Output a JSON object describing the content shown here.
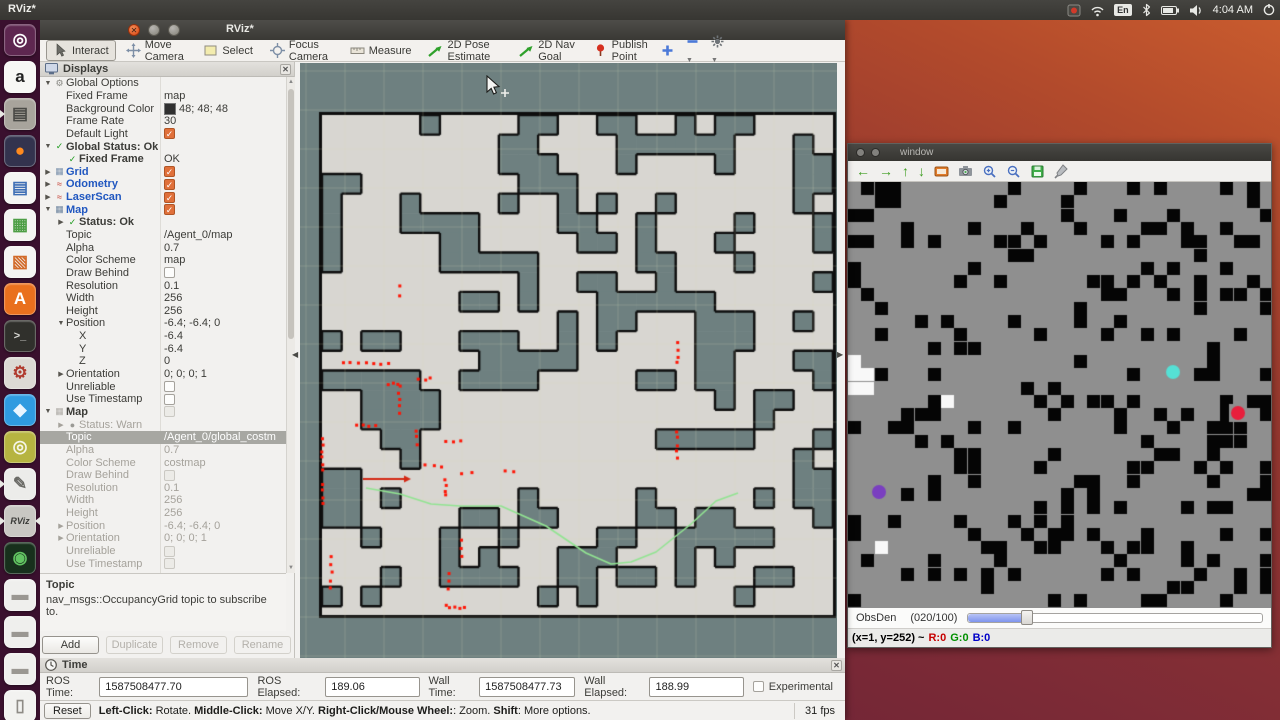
{
  "desktop": {
    "top_title": "RViz*",
    "clock": "4:04 AM",
    "keyboard_layout": "En"
  },
  "launcher": {
    "items": [
      {
        "id": "ubuntu-dash",
        "bg": "#5e2750",
        "fg": "#ffffff",
        "glyph": "◎",
        "run": false,
        "focus": false
      },
      {
        "id": "amazon",
        "bg": "#f7f7f5",
        "fg": "#222222",
        "glyph": "a",
        "run": false,
        "focus": false
      },
      {
        "id": "files",
        "bg": "#a8a49c",
        "fg": "#4a4a46",
        "glyph": "▤",
        "run": true,
        "focus": false
      },
      {
        "id": "firefox",
        "bg": "#33334e",
        "fg": "#ff8a1e",
        "glyph": "●",
        "run": false,
        "focus": false
      },
      {
        "id": "libreoffice-writer",
        "bg": "#f4f4f2",
        "fg": "#3f6fb5",
        "glyph": "▤",
        "run": false,
        "focus": false
      },
      {
        "id": "libreoffice-calc",
        "bg": "#f4f4f2",
        "fg": "#4d9e45",
        "glyph": "▦",
        "run": false,
        "focus": false
      },
      {
        "id": "libreoffice-impress",
        "bg": "#f4f4f2",
        "fg": "#d26a28",
        "glyph": "▧",
        "run": false,
        "focus": false
      },
      {
        "id": "ubuntu-software",
        "bg": "#e9701e",
        "fg": "#ffffff",
        "glyph": "A",
        "run": false,
        "focus": false
      },
      {
        "id": "terminal",
        "bg": "#30302c",
        "fg": "#d8d8d4",
        "glyph": ">_",
        "run": false,
        "focus": false
      },
      {
        "id": "system-settings",
        "bg": "#dcd9d4",
        "fg": "#b03a2e",
        "glyph": "⚙",
        "run": false,
        "focus": false
      },
      {
        "id": "vscode",
        "bg": "#2f9be0",
        "fg": "#eaf6ff",
        "glyph": "◆",
        "run": false,
        "focus": false
      },
      {
        "id": "screenshot-tool",
        "bg": "#b6b441",
        "fg": "#f5f5e8",
        "glyph": "◎",
        "run": false,
        "focus": false
      },
      {
        "id": "text-editor",
        "bg": "#ececea",
        "fg": "#6a6a66",
        "glyph": "✎",
        "run": true,
        "focus": false
      },
      {
        "id": "rviz",
        "bg": "#c9c7c3",
        "fg": "#3a3a38",
        "glyph": "RViz",
        "run": true,
        "focus": true
      },
      {
        "id": "camera-lens",
        "bg": "#17301c",
        "fg": "#62c462",
        "glyph": "◉",
        "run": false,
        "focus": false
      },
      {
        "id": "disk-drive-1",
        "bg": "#efefed",
        "fg": "#9a9792",
        "glyph": "▬",
        "run": false,
        "focus": false
      },
      {
        "id": "disk-drive-2",
        "bg": "#efefed",
        "fg": "#9a9792",
        "glyph": "▬",
        "run": false,
        "focus": false
      },
      {
        "id": "disk-drive-3",
        "bg": "#efefed",
        "fg": "#9a9792",
        "glyph": "▬",
        "run": false,
        "focus": false
      },
      {
        "id": "trash",
        "bg": "#f2f2f0",
        "fg": "#8e8b86",
        "glyph": "▯",
        "run": false,
        "focus": false
      }
    ]
  },
  "rviz": {
    "title": "RViz*",
    "toolbar": {
      "tools": [
        {
          "icon": "interact",
          "label": "Interact",
          "active": true
        },
        {
          "icon": "move-camera",
          "label": "Move Camera",
          "active": false
        },
        {
          "icon": "select",
          "label": "Select",
          "active": false
        },
        {
          "icon": "focus-camera",
          "label": "Focus Camera",
          "active": false
        },
        {
          "icon": "measure",
          "label": "Measure",
          "active": false
        },
        {
          "icon": "pose-estimate",
          "label": "2D Pose Estimate",
          "active": false
        },
        {
          "icon": "nav-goal",
          "label": "2D Nav Goal",
          "active": false
        },
        {
          "icon": "publish-point",
          "label": "Publish Point",
          "active": false
        }
      ]
    },
    "displays": {
      "title": "Displays",
      "rows": [
        [
          0,
          "v",
          "gear",
          "Global Options",
          "n",
          "",
          "",
          0
        ],
        [
          1,
          "",
          "",
          "Fixed Frame",
          "n",
          "map",
          "text",
          0
        ],
        [
          1,
          "",
          "",
          "Background Color",
          "n",
          "48; 48; 48",
          "color",
          0
        ],
        [
          1,
          "",
          "",
          "Frame Rate",
          "n",
          "30",
          "text",
          0
        ],
        [
          1,
          "",
          "",
          "Default Light",
          "n",
          "",
          "cb-on",
          0
        ],
        [
          0,
          "v",
          "check",
          "Global Status: Ok",
          "bd",
          "",
          "",
          0
        ],
        [
          1,
          "",
          "check",
          "Fixed Frame",
          "bd",
          "OK",
          "text",
          0
        ],
        [
          0,
          "r",
          "grid",
          "Grid",
          "b",
          "",
          "cb-on",
          0
        ],
        [
          0,
          "r",
          "odom",
          "Odometry",
          "b",
          "",
          "cb-on",
          0
        ],
        [
          0,
          "r",
          "laser",
          "LaserScan",
          "b",
          "",
          "cb-on",
          0
        ],
        [
          0,
          "v",
          "map",
          "Map",
          "b",
          "",
          "cb-on",
          0
        ],
        [
          1,
          "r",
          "check",
          "Status: Ok",
          "bd",
          "",
          "",
          0
        ],
        [
          1,
          "",
          "",
          "Topic",
          "n",
          "/Agent_0/map",
          "text",
          0
        ],
        [
          1,
          "",
          "",
          "Alpha",
          "n",
          "0.7",
          "text",
          0
        ],
        [
          1,
          "",
          "",
          "Color Scheme",
          "n",
          "map",
          "text",
          0
        ],
        [
          1,
          "",
          "",
          "Draw Behind",
          "n",
          "",
          "cb-off",
          0
        ],
        [
          1,
          "",
          "",
          "Resolution",
          "n",
          "0.1",
          "text",
          0
        ],
        [
          1,
          "",
          "",
          "Width",
          "n",
          "256",
          "text",
          0
        ],
        [
          1,
          "",
          "",
          "Height",
          "n",
          "256",
          "text",
          0
        ],
        [
          1,
          "v",
          "",
          "Position",
          "n",
          "-6.4; -6.4; 0",
          "text",
          0
        ],
        [
          2,
          "",
          "",
          "X",
          "n",
          "-6.4",
          "text",
          0
        ],
        [
          2,
          "",
          "",
          "Y",
          "n",
          "-6.4",
          "text",
          0
        ],
        [
          2,
          "",
          "",
          "Z",
          "n",
          "0",
          "text",
          0
        ],
        [
          1,
          "r",
          "",
          "Orientation",
          "n",
          "0; 0; 0; 1",
          "text",
          0
        ],
        [
          1,
          "",
          "",
          "Unreliable",
          "n",
          "",
          "cb-off",
          0
        ],
        [
          1,
          "",
          "",
          "Use Timestamp",
          "n",
          "",
          "cb-off",
          0
        ],
        [
          0,
          "v",
          "mapg",
          "Map",
          "bd",
          "",
          "cb-dis",
          0
        ],
        [
          1,
          "r",
          "warn",
          "Status: Warn",
          "g",
          "",
          "",
          0
        ],
        [
          1,
          "",
          "",
          "Topic",
          "n",
          "/Agent_0/global_costm",
          "text",
          1
        ],
        [
          1,
          "",
          "",
          "Alpha",
          "g",
          "0.7",
          "text",
          0
        ],
        [
          1,
          "",
          "",
          "Color Scheme",
          "g",
          "costmap",
          "text",
          0
        ],
        [
          1,
          "",
          "",
          "Draw Behind",
          "g",
          "",
          "cb-dis",
          0
        ],
        [
          1,
          "",
          "",
          "Resolution",
          "g",
          "0.1",
          "text",
          0
        ],
        [
          1,
          "",
          "",
          "Width",
          "g",
          "256",
          "text",
          0
        ],
        [
          1,
          "",
          "",
          "Height",
          "g",
          "256",
          "text",
          0
        ],
        [
          1,
          "r",
          "",
          "Position",
          "g",
          "-6.4; -6.4; 0",
          "text",
          0
        ],
        [
          1,
          "r",
          "",
          "Orientation",
          "g",
          "0; 0; 0; 1",
          "text",
          0
        ],
        [
          1,
          "",
          "",
          "Unreliable",
          "g",
          "",
          "cb-dis",
          0
        ],
        [
          1,
          "",
          "",
          "Use Timestamp",
          "g",
          "",
          "cb-dis",
          0
        ]
      ],
      "help_title": "Topic",
      "help_text": "nav_msgs::OccupancyGrid topic to subscribe to.",
      "buttons": [
        {
          "label": "Add",
          "enabled": true
        },
        {
          "label": "Duplicate",
          "enabled": false
        },
        {
          "label": "Remove",
          "enabled": false
        },
        {
          "label": "Rename",
          "enabled": false
        }
      ]
    },
    "time_panel": {
      "title": "Time",
      "fields": [
        {
          "label": "ROS Time:",
          "value": "1587508477.70",
          "width": 150
        },
        {
          "label": "ROS Elapsed:",
          "value": "189.06",
          "width": 90
        },
        {
          "label": "Wall Time:",
          "value": "1587508477.73",
          "width": 92
        },
        {
          "label": "Wall Elapsed:",
          "value": "188.99",
          "width": 90
        }
      ],
      "experimental_label": "Experimental"
    },
    "status_bar": {
      "reset_label": "Reset",
      "segments": [
        [
          "Left-Click:",
          1
        ],
        [
          " Rotate. ",
          0
        ],
        [
          "Middle-Click:",
          1
        ],
        [
          " Move X/Y. ",
          0
        ],
        [
          "Right-Click/Mouse Wheel:",
          1
        ],
        [
          ": Zoom. ",
          0
        ],
        [
          "Shift",
          1
        ],
        [
          ": More options.",
          0
        ]
      ],
      "fps": "31 fps"
    }
  },
  "viewport": {
    "w": 537,
    "h": 596,
    "bg": "#6e8080",
    "grid_color": "rgba(220,220,180,0.22)",
    "grid_step": 39,
    "map": {
      "x": 22,
      "y": 52,
      "w": 511,
      "h": 500,
      "free": "#d8d6d1",
      "obstacle": "#6e8080",
      "stroke": "#0e0e0e",
      "cell": 19.65,
      "density": 0.13,
      "spread": 0.33,
      "notch_p": 0.26,
      "seed": 20
    },
    "path": {
      "color": "#92e492",
      "width": 1.6,
      "points": [
        [
          66,
          425
        ],
        [
          100,
          431
        ],
        [
          131,
          441
        ],
        [
          160,
          443
        ],
        [
          201,
          443
        ],
        [
          246,
          463
        ],
        [
          286,
          490
        ],
        [
          311,
          501
        ],
        [
          331,
          499
        ],
        [
          356,
          489
        ],
        [
          391,
          461
        ],
        [
          416,
          438
        ],
        [
          438,
          430
        ]
      ]
    },
    "arrow": {
      "color": "#d42814",
      "x1": 63,
      "y1": 416,
      "x2": 111,
      "y2": 416
    },
    "laser": {
      "color": "#ff1505",
      "size": 3,
      "seed": 99,
      "segments": [
        [
          23,
          375,
          23,
          408,
          6
        ],
        [
          23,
          421,
          23,
          441,
          4
        ],
        [
          31,
          493,
          31,
          525,
          5
        ],
        [
          43,
          300,
          88,
          301,
          7
        ],
        [
          88,
          321,
          99,
          321,
          3
        ],
        [
          99,
          323,
          99,
          350,
          5
        ],
        [
          56,
          363,
          76,
          363,
          4
        ],
        [
          99,
          224,
          99,
          234,
          2
        ],
        [
          116,
          368,
          116,
          381,
          3
        ],
        [
          119,
          316,
          131,
          316,
          3
        ],
        [
          146,
          378,
          161,
          378,
          3
        ],
        [
          126,
          403,
          141,
          403,
          3
        ],
        [
          161,
          410,
          171,
          410,
          2
        ],
        [
          146,
          416,
          146,
          433,
          4
        ],
        [
          149,
          511,
          149,
          526,
          3
        ],
        [
          161,
          478,
          161,
          493,
          3
        ],
        [
          146,
          543,
          164,
          545,
          5
        ],
        [
          377,
          280,
          377,
          300,
          4
        ],
        [
          377,
          368,
          377,
          396,
          5
        ],
        [
          204,
          408,
          214,
          408,
          2
        ]
      ]
    }
  },
  "cv_window": {
    "title": "window",
    "toolbar_icons": [
      "left-arrow",
      "right-arrow",
      "up-arrow",
      "down-arrow",
      "image",
      "camera",
      "zoom-in",
      "zoom-out",
      "save",
      "brush"
    ],
    "slider": {
      "label": "ObsDen",
      "value_text": "(020/100)",
      "fraction": 0.2
    },
    "status": {
      "coords": "(x=1, y=252) ~",
      "r": "R:0",
      "g": "G:0",
      "b": "B:0"
    },
    "canvas": {
      "w": 423,
      "h": 426,
      "bg": "#8f8f8f",
      "black": "#050505",
      "white": "#f8f8f8",
      "cell": 13.3,
      "cols": 32,
      "rows": 33,
      "density": 0.21,
      "seed": 777,
      "white_cells": [
        [
          0,
          13
        ],
        [
          0,
          14
        ],
        [
          1,
          14
        ],
        [
          0,
          15
        ],
        [
          1,
          15
        ],
        [
          7,
          16
        ],
        [
          2,
          27
        ]
      ],
      "dots": [
        {
          "name": "agent-cyan",
          "x": 325,
          "y": 190,
          "r": 7,
          "color": "#55e0d5"
        },
        {
          "name": "agent-red",
          "x": 390,
          "y": 231,
          "r": 7,
          "color": "#e81f3c"
        },
        {
          "name": "agent-purple",
          "x": 31,
          "y": 310,
          "r": 7,
          "color": "#7a3fc0"
        }
      ]
    }
  }
}
